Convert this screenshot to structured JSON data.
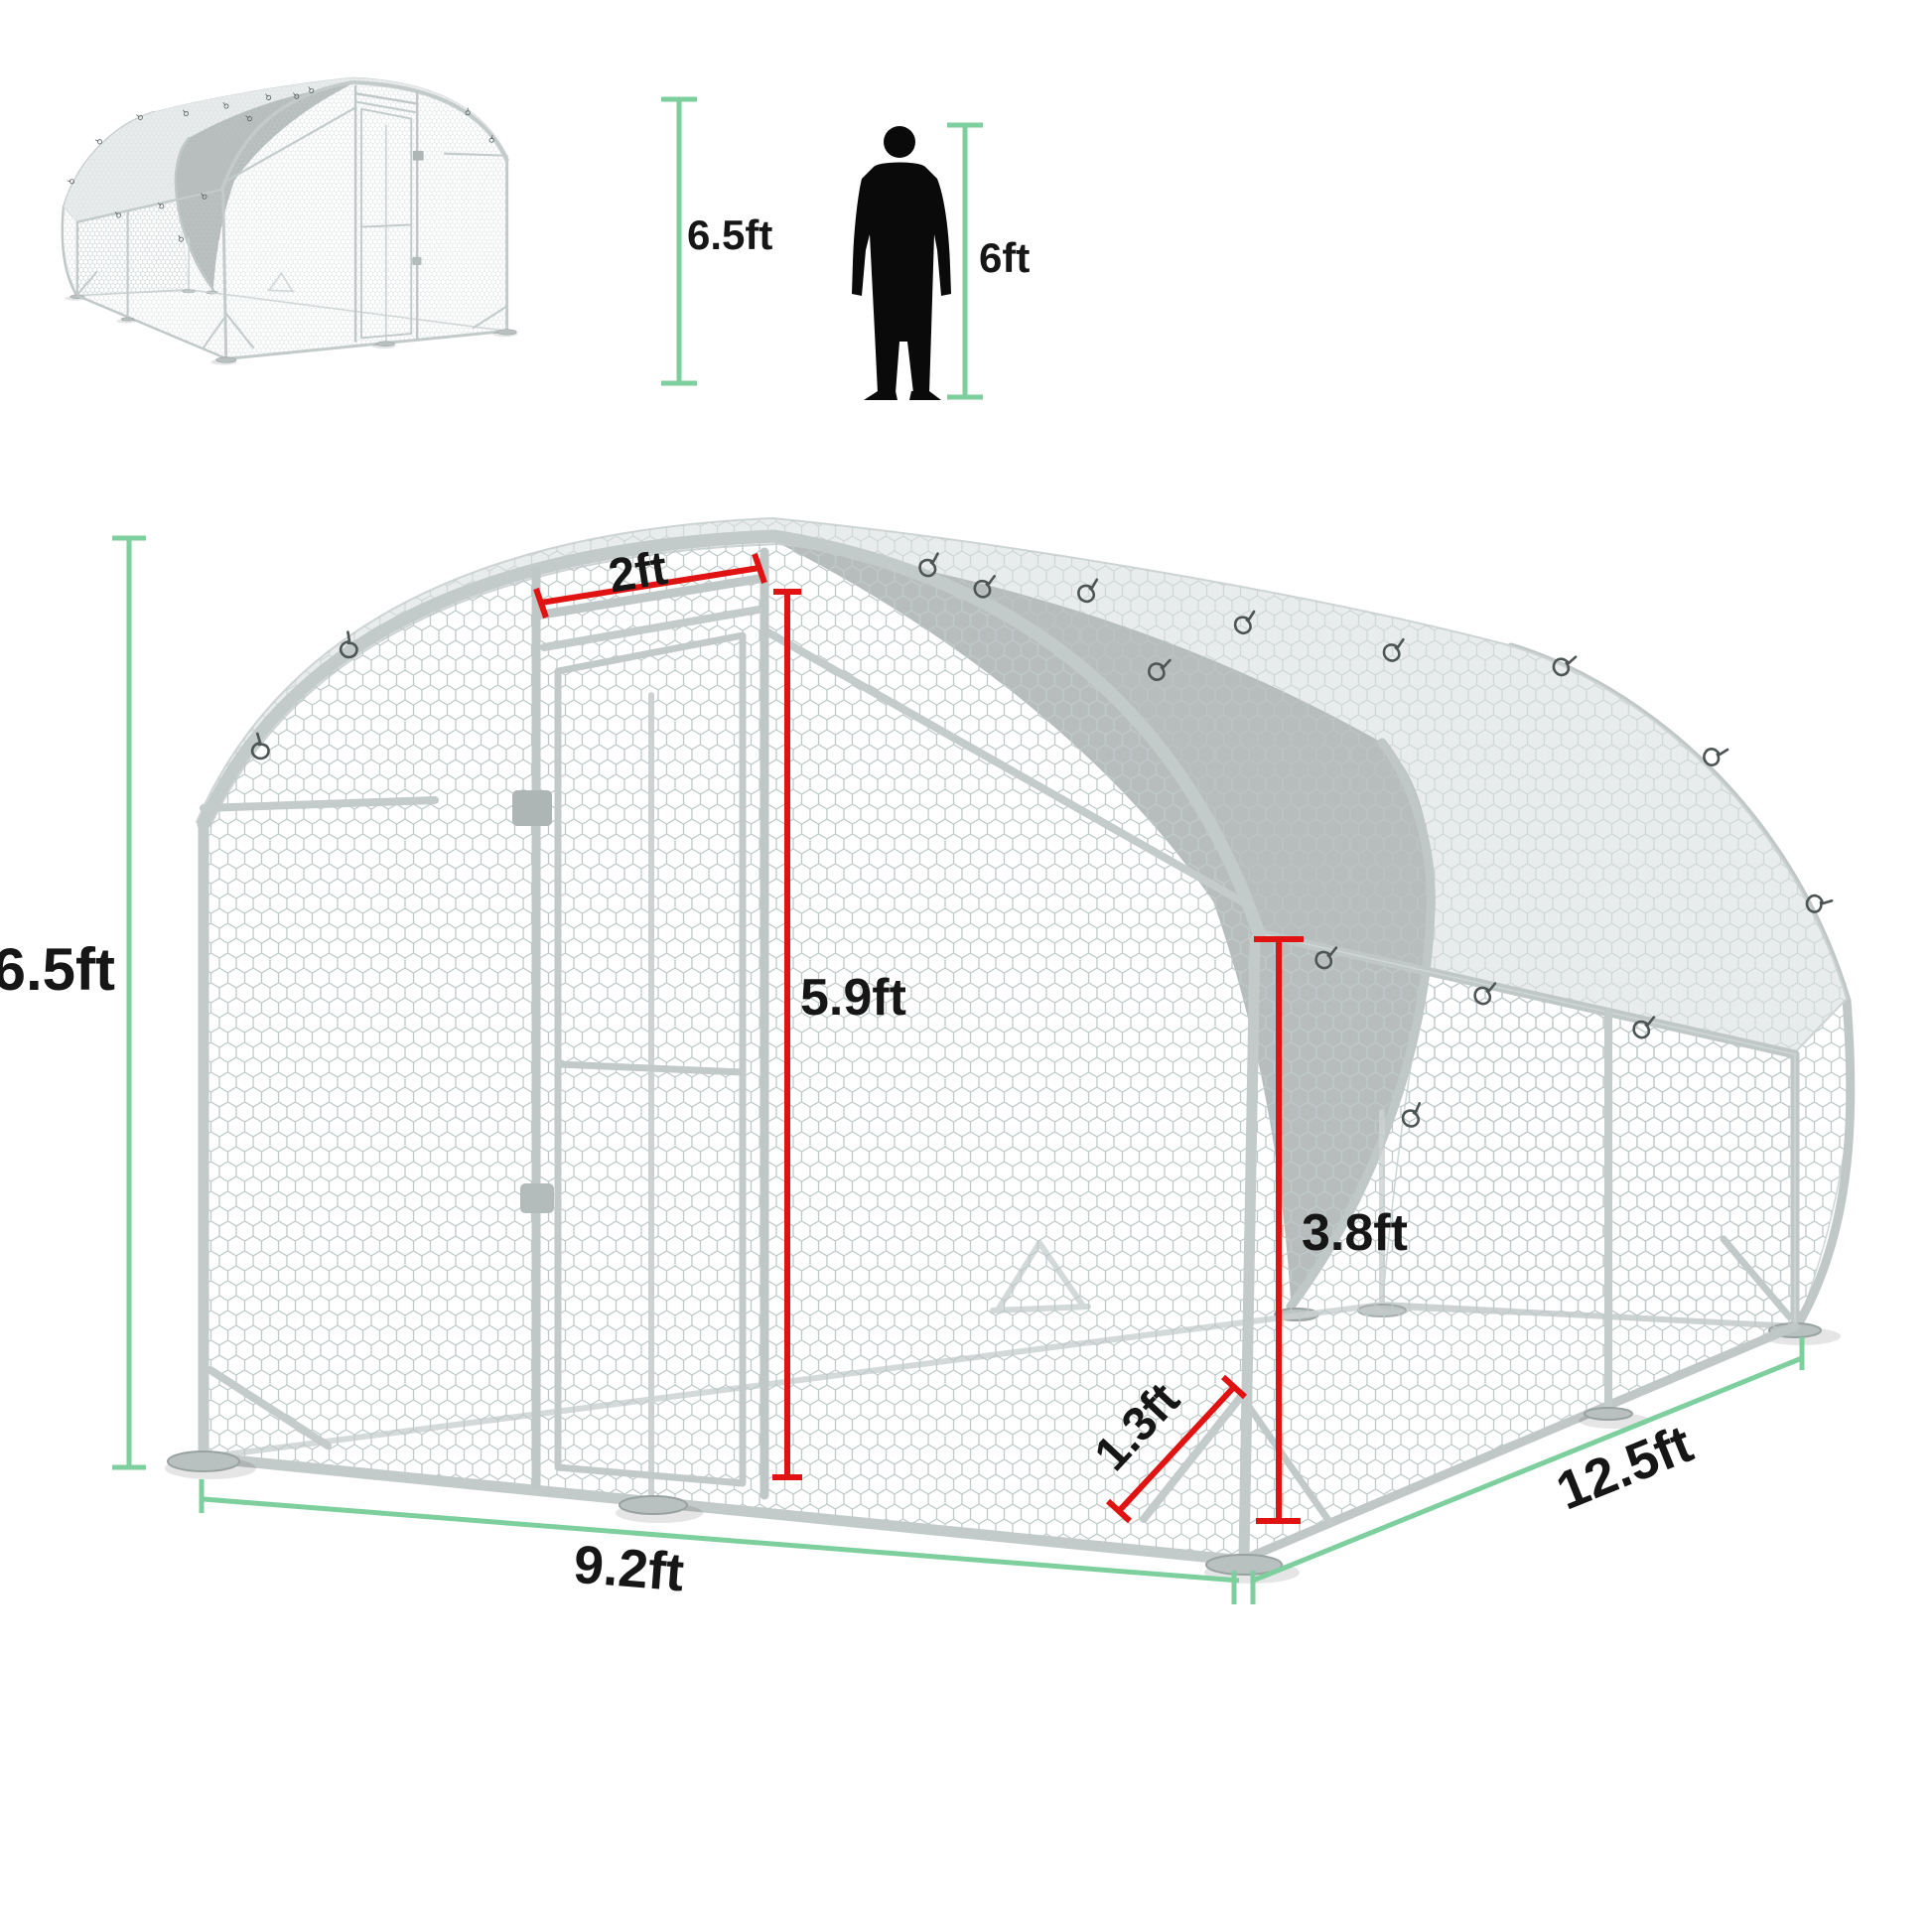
{
  "title": "Walk-in metal chicken run dimension diagram",
  "scale_reference": {
    "coop_height": "6.5ft",
    "person_height": "6ft",
    "person_icon": "person-silhouette-icon"
  },
  "dimensions": {
    "total_height": "6.5ft",
    "door_width": "2ft",
    "door_height": "5.9ft",
    "side_wall_height": "3.8ft",
    "corner_brace": "1.3ft",
    "front_width": "9.2ft",
    "run_depth": "12.5ft"
  },
  "colors": {
    "measure_green": "#7ecf9e",
    "measure_red": "#e11212",
    "label_text": "#161616",
    "tarp_light": "#e9ecec",
    "tarp_dark": "#b7bdbd",
    "frame_gray": "#c3caca",
    "silhouette_black": "#0a0a0a"
  }
}
